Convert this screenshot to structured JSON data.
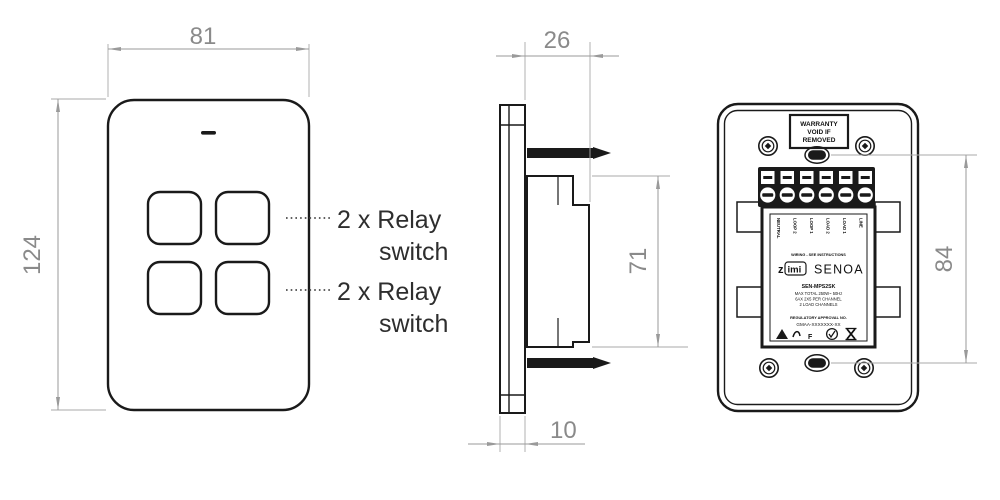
{
  "front_view": {
    "width_dim": "81",
    "height_dim": "124",
    "annotations": [
      {
        "line1": "2 x Relay",
        "line2": "switch"
      },
      {
        "line1": "2 x Relay",
        "line2": "switch"
      }
    ]
  },
  "side_view": {
    "depth_dim": "26",
    "mount_height_dim": "71",
    "faceplate_depth_dim": "10"
  },
  "back_view": {
    "mount_spacing_dim": "84",
    "warranty_label": {
      "line1": "WARRANTY",
      "line2": "VOID IF",
      "line3": "REMOVED"
    },
    "terminal_labels": [
      "NEUTRAL",
      "LOOP 2",
      "LOOP 1",
      "LOAD 2",
      "LOAD 1",
      "LINE"
    ],
    "wiring_note": "WIRING - SEE INSTRUCTIONS",
    "brand_z": "z",
    "brand_imi": "imi",
    "product": "SENOA",
    "model": "SEN-MPS2SK",
    "rating_line1": "MAX TOTAL 250W~ 50Hz",
    "rating_line2": "6AX 2X5 PER CHANNEL",
    "rating_line3": "2 LOAD CHANNELS",
    "approval_title": "REGULATORY APPROVAL NO.",
    "approval_code": "GMAA-XXXXXXX-XX",
    "f_mark": "F"
  },
  "colors": {
    "ink": "#1a1a1a",
    "dimension_line": "#9a9a9a",
    "dimension_text": "#8a8a8a",
    "annotation_text": "#2e2e2e"
  }
}
